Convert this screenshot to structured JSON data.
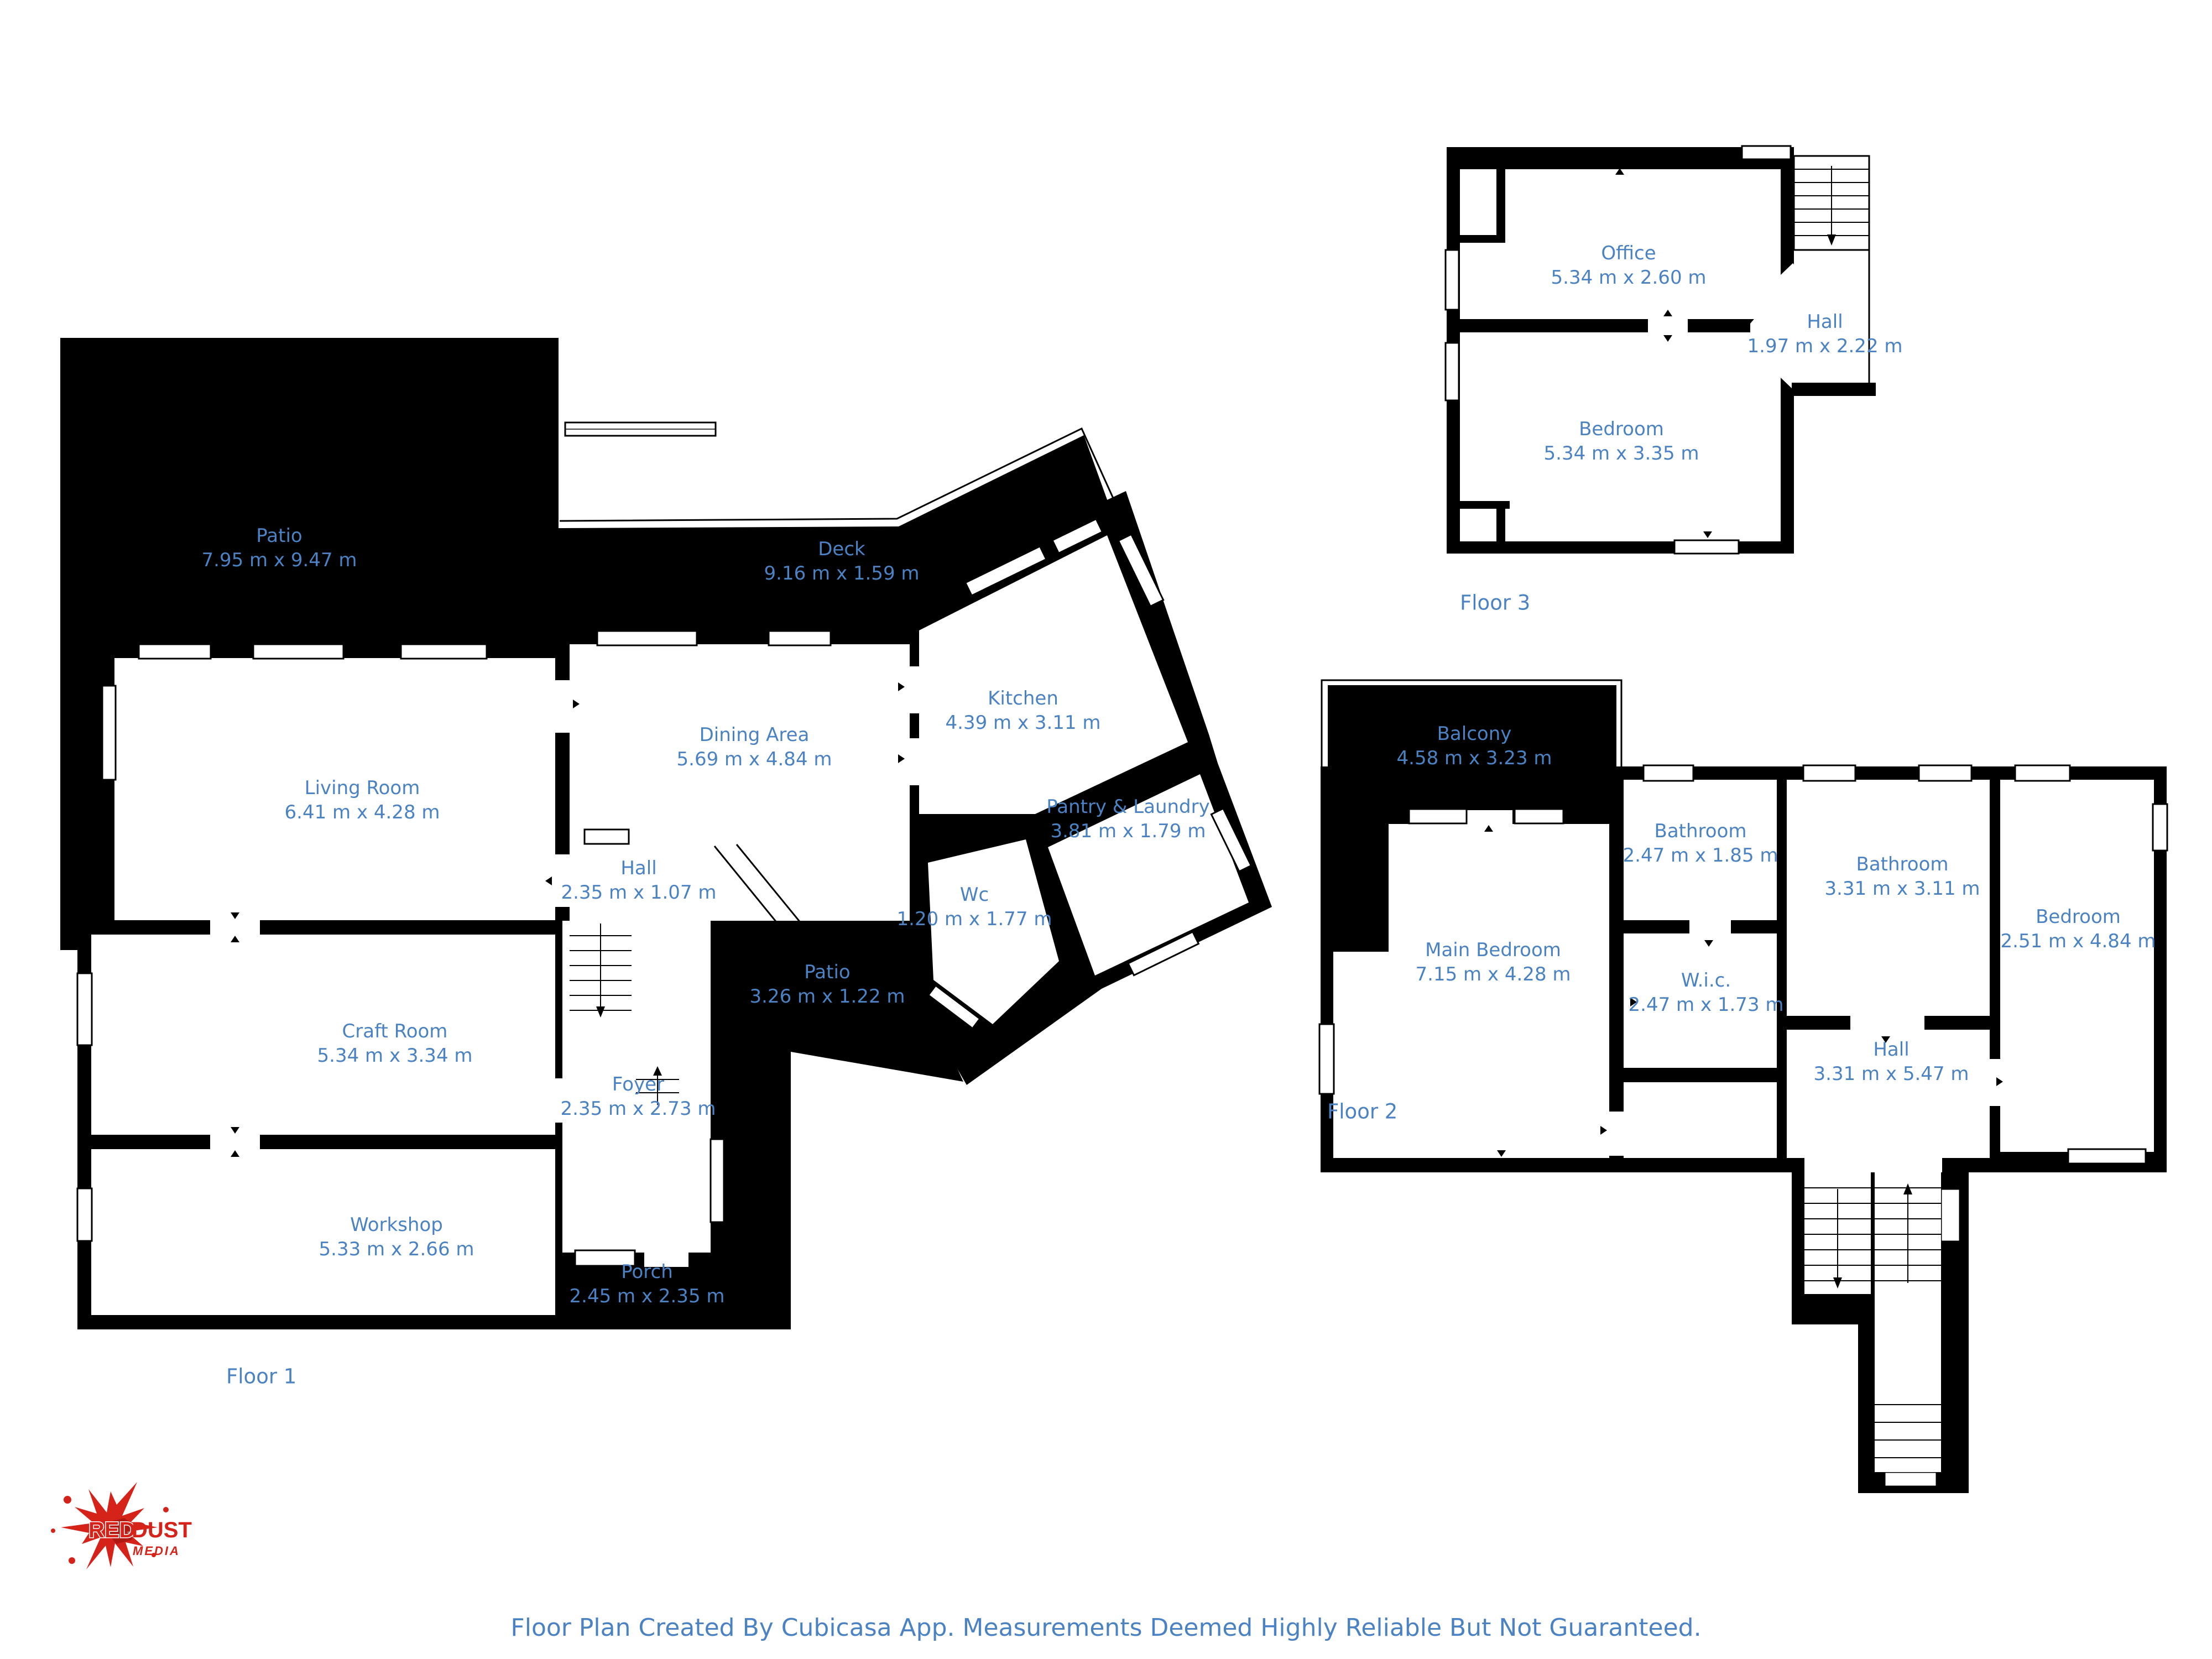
{
  "colors": {
    "label_blue": "#4a82c3",
    "wall_black": "#000000",
    "logo_red": "#d6231a"
  },
  "footer": {
    "caption": "Floor Plan Created By Cubicasa App. Measurements Deemed Highly Reliable But Not Guaranteed."
  },
  "logo": {
    "word1": "RED",
    "word2": "DUST",
    "word3": "MEDIA"
  },
  "floors": [
    {
      "label": "Floor 1",
      "rooms": [
        {
          "name": "Patio",
          "dims": "7.95 m x 9.47 m"
        },
        {
          "name": "Deck",
          "dims": "9.16 m x 1.59 m"
        },
        {
          "name": "Kitchen",
          "dims": "4.39 m x 3.11 m"
        },
        {
          "name": "Dining Area",
          "dims": "5.69 m x 4.84 m"
        },
        {
          "name": "Living Room",
          "dims": "6.41 m x 4.28 m"
        },
        {
          "name": "Pantry & Laundry",
          "dims": "3.81 m x 1.79 m"
        },
        {
          "name": "Wc",
          "dims": "1.20 m x 1.77 m"
        },
        {
          "name": "Hall",
          "dims": "2.35 m x 1.07 m"
        },
        {
          "name": "Patio",
          "dims": "3.26 m x 1.22 m"
        },
        {
          "name": "Craft Room",
          "dims": "5.34 m x 3.34 m"
        },
        {
          "name": "Foyer",
          "dims": "2.35 m x 2.73 m"
        },
        {
          "name": "Workshop",
          "dims": "5.33 m x 2.66 m"
        },
        {
          "name": "Porch",
          "dims": "2.45 m x 2.35 m"
        }
      ]
    },
    {
      "label": "Floor 2",
      "rooms": [
        {
          "name": "Balcony",
          "dims": "4.58 m x 3.23 m"
        },
        {
          "name": "Bathroom",
          "dims": "2.47 m x 1.85 m"
        },
        {
          "name": "Bathroom",
          "dims": "3.31 m x 3.11 m"
        },
        {
          "name": "Bedroom",
          "dims": "2.51 m x 4.84 m"
        },
        {
          "name": "Main Bedroom",
          "dims": "7.15 m x 4.28 m"
        },
        {
          "name": "W.i.c.",
          "dims": "2.47 m x 1.73 m"
        },
        {
          "name": "Hall",
          "dims": "3.31 m x 5.47 m"
        }
      ]
    },
    {
      "label": "Floor 3",
      "rooms": [
        {
          "name": "Office",
          "dims": "5.34 m x 2.60 m"
        },
        {
          "name": "Hall",
          "dims": "1.97 m x 2.22 m"
        },
        {
          "name": "Bedroom",
          "dims": "5.34 m x 3.35 m"
        }
      ]
    }
  ]
}
